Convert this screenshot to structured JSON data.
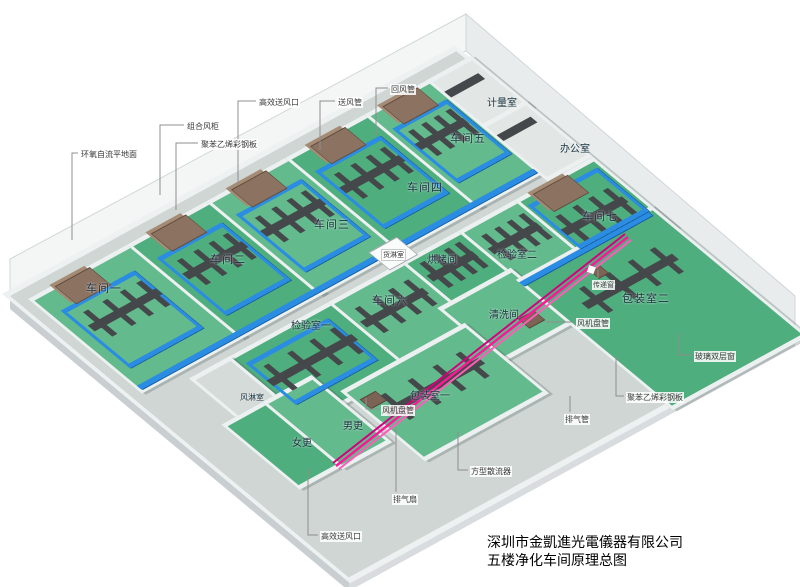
{
  "meta": {
    "company_line": "深圳市金凱進光電儀器有限公司",
    "drawing_title": "五楼净化车间原理总图"
  },
  "rooms": {
    "ws1": "车间一",
    "ws2": "车间二",
    "ws3": "车间三",
    "ws4": "车间四",
    "ws5": "车间五",
    "ws6": "车间六",
    "ws7": "车间七",
    "metering": "计量室",
    "office": "办公室",
    "cargo_shower": "货淋室",
    "baking": "烘烤间",
    "inspection1": "检验室一",
    "inspection2": "检验室二",
    "washing": "清洗间",
    "packing1": "包装室一",
    "packing2": "包装室二",
    "air_shower": "风淋室",
    "female_change": "女更",
    "male_change": "男更"
  },
  "callouts": {
    "epoxy_floor": "环氧自流平地面",
    "ahu": "组合风柜",
    "panel": "聚苯乙烯彩钢板",
    "hepa_outlet": "高效送风口",
    "supply_duct": "送风管",
    "return_duct": "回风管",
    "fan_coil": "风机盘管",
    "fan_coil2": "风机盘管",
    "exhaust_fan": "排气扇",
    "square_diffuser": "方型散流器",
    "hepa_outlet2": "高效送风口",
    "exhaust_pipe": "排气管",
    "glass_window": "玻璃双层窗",
    "panel2": "聚苯乙烯彩钢板",
    "transfer_window": "传递窗"
  },
  "colors": {
    "floor_green": "#4fae7e",
    "duct_blue": "#2a8ce2",
    "duct_gray": "#45484a",
    "ahu_brown": "#8b7261",
    "exhaust_pink": "#ff1699",
    "slab_gray": "#e9edee"
  }
}
